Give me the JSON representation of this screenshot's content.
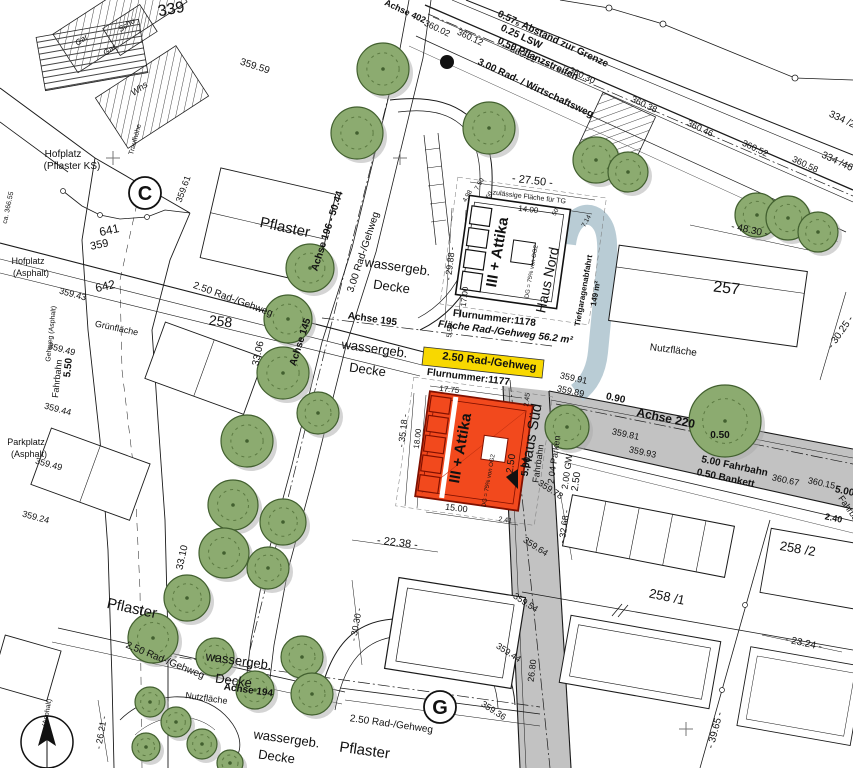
{
  "map": {
    "colors": {
      "tree_green": "#8cab70",
      "tree_outline": "#42602f",
      "tree_inner": "#5c7a42",
      "shadow_gray": "#a9a9a9",
      "road_gray": "#c2c2c2",
      "ramp_blue": "#b5c9d3",
      "path_yellow": "#f8d800",
      "building_red": "#f2491d",
      "building_red_border": "#801000",
      "line_black": "#1a1a1a"
    },
    "markers": [
      {
        "letter": "C"
      },
      {
        "letter": "G"
      }
    ],
    "labels": [
      {
        "t": "Achse 402",
        "x": 404,
        "y": 14,
        "r": 25,
        "s": 9,
        "b": 1
      },
      {
        "t": "360.02",
        "x": 436,
        "y": 31,
        "r": 25,
        "s": 9
      },
      {
        "t": "360.12",
        "x": 469,
        "y": 40,
        "r": 25,
        "s": 9
      },
      {
        "t": "360.22",
        "x": 522,
        "y": 57,
        "r": 25,
        "s": 9
      },
      {
        "t": "360.30",
        "x": 581,
        "y": 78,
        "r": 25,
        "s": 9
      },
      {
        "t": "360.38",
        "x": 643,
        "y": 107,
        "r": 25,
        "s": 9
      },
      {
        "t": "360.46",
        "x": 699,
        "y": 131,
        "r": 25,
        "s": 9
      },
      {
        "t": "360.52",
        "x": 754,
        "y": 151,
        "r": 25,
        "s": 9
      },
      {
        "t": "360.58",
        "x": 804,
        "y": 167,
        "r": 25,
        "s": 9
      },
      {
        "t": "0.57₅ Abstand zur Grenze",
        "x": 497,
        "y": 16,
        "r": 25,
        "s": 10,
        "b": 1,
        "a": "s"
      },
      {
        "t": "0.25 LSW",
        "x": 500,
        "y": 30,
        "r": 25,
        "s": 10,
        "b": 1,
        "a": "s"
      },
      {
        "t": "0.50 Pflanzstreifen",
        "x": 497,
        "y": 43,
        "r": 25,
        "s": 10,
        "b": 1,
        "a": "s"
      },
      {
        "t": "3.00 Rad- / Wirtschaftsweg",
        "x": 477,
        "y": 64,
        "r": 25,
        "s": 10,
        "b": 1,
        "a": "s"
      },
      {
        "t": "334 /2",
        "x": 841,
        "y": 122,
        "r": 25,
        "s": 10
      },
      {
        "t": "334 /46",
        "x": 836,
        "y": 164,
        "r": 25,
        "s": 10
      },
      {
        "t": "339",
        "x": 172,
        "y": 14,
        "r": -10,
        "s": 16
      },
      {
        "t": "359.59",
        "x": 254,
        "y": 69,
        "r": 18,
        "s": 10
      },
      {
        "t": "Schu",
        "x": 128,
        "y": 27,
        "r": -35,
        "s": 8,
        "i": 1
      },
      {
        "t": "Gar",
        "x": 83,
        "y": 42,
        "r": -35,
        "s": 8,
        "i": 1
      },
      {
        "t": "Gar",
        "x": 111,
        "y": 52,
        "r": -35,
        "s": 8,
        "i": 1
      },
      {
        "t": "Whs",
        "x": 141,
        "y": 91,
        "r": -35,
        "s": 9,
        "i": 1
      },
      {
        "t": "Traufhöhe",
        "x": 137,
        "y": 140,
        "r": -75,
        "s": 7
      },
      {
        "t": "ca. 366.55",
        "x": 10,
        "y": 208,
        "r": -78,
        "s": 7
      },
      {
        "t": "Hofplatz",
        "x": 63,
        "y": 157,
        "s": 10
      },
      {
        "t": "(Pflaster KS)",
        "x": 72,
        "y": 169,
        "s": 10
      },
      {
        "t": "359.61",
        "x": 186,
        "y": 190,
        "r": -70,
        "s": 9
      },
      {
        "t": "641",
        "x": 110,
        "y": 234,
        "r": -12,
        "s": 12
      },
      {
        "t": "359",
        "x": 100,
        "y": 248,
        "r": -12,
        "s": 11
      },
      {
        "t": "642",
        "x": 106,
        "y": 290,
        "r": -12,
        "s": 12
      },
      {
        "t": "359.43",
        "x": 72,
        "y": 297,
        "r": 15,
        "s": 9
      },
      {
        "t": "Hofplatz",
        "x": 28,
        "y": 264,
        "s": 9
      },
      {
        "t": "(Asphalt)",
        "x": 31,
        "y": 276,
        "s": 9
      },
      {
        "t": "Pflaster",
        "x": 284,
        "y": 232,
        "r": 12,
        "s": 15
      },
      {
        "t": "Achse 196 - 50.44",
        "x": 330,
        "y": 232,
        "r": -72,
        "s": 10,
        "b": 1
      },
      {
        "t": "3.00 Rad-/Gehweg",
        "x": 366,
        "y": 253,
        "r": -72,
        "s": 10
      },
      {
        "t": "wassergeb.",
        "x": 397,
        "y": 271,
        "r": 8,
        "s": 13
      },
      {
        "t": "Decke",
        "x": 391,
        "y": 291,
        "r": 8,
        "s": 13
      },
      {
        "t": "2.50 Rad-/Gehweg",
        "x": 232,
        "y": 302,
        "r": 20,
        "s": 10
      },
      {
        "t": "Achse 195",
        "x": 372,
        "y": 322,
        "r": 8,
        "s": 10,
        "b": 1
      },
      {
        "t": "wassergeb.",
        "x": 374,
        "y": 353,
        "r": 8,
        "s": 13
      },
      {
        "t": "Decke",
        "x": 367,
        "y": 374,
        "r": 8,
        "s": 13
      },
      {
        "t": "Achse 145",
        "x": 303,
        "y": 343,
        "r": -72,
        "s": 10,
        "b": 1
      },
      {
        "t": "33.06",
        "x": 261,
        "y": 354,
        "r": -78,
        "s": 10
      },
      {
        "t": "258",
        "x": 220,
        "y": 326,
        "r": 7,
        "s": 14
      },
      {
        "t": "33.10",
        "x": 185,
        "y": 558,
        "r": -78,
        "s": 10
      },
      {
        "t": "- 30.30 -",
        "x": 359,
        "y": 625,
        "r": -80,
        "s": 9
      },
      {
        "t": "- 22.38 -",
        "x": 397,
        "y": 546,
        "r": 7,
        "s": 11
      },
      {
        "t": "- 26.21 -",
        "x": 104,
        "y": 733,
        "r": -80,
        "s": 9
      },
      {
        "t": "Pflaster",
        "x": 131,
        "y": 613,
        "r": 12,
        "s": 15
      },
      {
        "t": "2.50 Rad-/Gehweg",
        "x": 164,
        "y": 663,
        "r": 22,
        "s": 10
      },
      {
        "t": "wassergeb.",
        "x": 238,
        "y": 665,
        "r": 8,
        "s": 13
      },
      {
        "t": "Decke",
        "x": 233,
        "y": 685,
        "r": 8,
        "s": 13
      },
      {
        "t": "Achse 194",
        "x": 248,
        "y": 693,
        "r": 8,
        "s": 10,
        "b": 1
      },
      {
        "t": "Nutzfläche",
        "x": 206,
        "y": 701,
        "r": 8,
        "s": 9,
        "c": "#9c9c9c"
      },
      {
        "t": "2.50 Rad-/Gehweg",
        "x": 391,
        "y": 727,
        "r": 8,
        "s": 10
      },
      {
        "t": "wassergeb.",
        "x": 286,
        "y": 743,
        "r": 8,
        "s": 13
      },
      {
        "t": "Decke",
        "x": 276,
        "y": 761,
        "r": 8,
        "s": 13
      },
      {
        "t": "Pflaster",
        "x": 364,
        "y": 755,
        "r": 8,
        "s": 15
      },
      {
        "t": "359.44",
        "x": 507,
        "y": 655,
        "r": 33,
        "s": 9
      },
      {
        "t": "359.36",
        "x": 492,
        "y": 713,
        "r": 33,
        "s": 9
      },
      {
        "t": "26.80",
        "x": 535,
        "y": 671,
        "r": -83,
        "s": 9
      },
      {
        "t": "- 27.50 -",
        "x": 532,
        "y": 184,
        "r": 7,
        "s": 11
      },
      {
        "t": "zulässige Fläche für TG",
        "x": 529,
        "y": 199,
        "r": 7,
        "s": 7,
        "c": "#8a8a8a"
      },
      {
        "t": "14.00",
        "x": 528,
        "y": 212,
        "r": 7,
        "s": 8
      },
      {
        "t": "4.98",
        "x": 469,
        "y": 197,
        "r": -60,
        "s": 6.5
      },
      {
        "t": "7.50",
        "x": 481,
        "y": 185,
        "r": -60,
        "s": 6.5
      },
      {
        "t": "50",
        "x": 491,
        "y": 196,
        "r": -60,
        "s": 6.5
      },
      {
        "t": "50",
        "x": 557,
        "y": 213,
        "r": -60,
        "s": 6.5
      },
      {
        "t": "7.14",
        "x": 588,
        "y": 222,
        "r": -60,
        "s": 6.5
      },
      {
        "t": "- 29.88 -",
        "x": 453,
        "y": 264,
        "r": -83,
        "s": 9
      },
      {
        "t": "17.00",
        "x": 467,
        "y": 297,
        "r": -83,
        "s": 8
      },
      {
        "t": "5.50",
        "x": 452,
        "y": 331,
        "r": -83,
        "s": 7
      },
      {
        "t": "III + Attika",
        "x": 502,
        "y": 253,
        "r": -80,
        "s": 15,
        "b": 1
      },
      {
        "t": "DG = 75% von OG2",
        "x": 533,
        "y": 272,
        "r": -80,
        "s": 6
      },
      {
        "t": "Haus Nord",
        "x": 552,
        "y": 281,
        "r": -78,
        "s": 14
      },
      {
        "t": "Tiefgaragenabfahrt",
        "x": 586,
        "y": 291,
        "r": -80,
        "s": 8,
        "b": 1
      },
      {
        "t": "149 m²",
        "x": 598,
        "y": 294,
        "r": -80,
        "s": 8,
        "b": 1
      },
      {
        "t": "Flurnummer:1178",
        "x": 494,
        "y": 321,
        "r": 7,
        "s": 10,
        "b": 1
      },
      {
        "t": "Fläche Rad-/Gehweg 56.2 m²",
        "x": 505,
        "y": 335,
        "r": 7,
        "s": 10,
        "b": 1,
        "i": 1
      },
      {
        "t": "2.50 Rad-/Gehweg",
        "x": 489,
        "y": 365,
        "r": 7,
        "s": 11,
        "b": 1
      },
      {
        "t": "Flurnummer:1177",
        "x": 468,
        "y": 380,
        "r": 7,
        "s": 10,
        "b": 1
      },
      {
        "t": "17.75",
        "x": 449,
        "y": 392,
        "r": 7,
        "s": 8
      },
      {
        "t": "- 35.18 -",
        "x": 406,
        "y": 431,
        "r": -83,
        "s": 9
      },
      {
        "t": "18.00",
        "x": 420,
        "y": 439,
        "r": -83,
        "s": 8
      },
      {
        "t": "III + Attika",
        "x": 465,
        "y": 449,
        "r": -80,
        "s": 15,
        "b": 1
      },
      {
        "t": "DG = 75% von OG2",
        "x": 490,
        "y": 481,
        "r": -80,
        "s": 6
      },
      {
        "t": "15.00",
        "x": 456,
        "y": 511,
        "r": 7,
        "s": 9
      },
      {
        "t": "2.45",
        "x": 529,
        "y": 400,
        "r": -83,
        "s": 7
      },
      {
        "t": "2.41",
        "x": 505,
        "y": 522,
        "r": 7,
        "s": 7
      },
      {
        "t": "Haus Süd",
        "x": 536,
        "y": 437,
        "r": -80,
        "s": 15
      },
      {
        "t": "2.50",
        "x": 514,
        "y": 464,
        "r": -82,
        "s": 10
      },
      {
        "t": "5.00",
        "x": 529,
        "y": 467,
        "r": -82,
        "s": 10,
        "b": 1
      },
      {
        "t": "Fahrbahn",
        "x": 541,
        "y": 464,
        "r": -82,
        "s": 9
      },
      {
        "t": "2.04 Parken",
        "x": 557,
        "y": 460,
        "r": -82,
        "s": 9
      },
      {
        "t": "2.00 GW",
        "x": 570,
        "y": 472,
        "r": -82,
        "s": 9
      },
      {
        "t": "2.50",
        "x": 579,
        "y": 482,
        "r": -82,
        "s": 10
      },
      {
        "t": "- 32.68 -",
        "x": 567,
        "y": 527,
        "r": -82,
        "s": 9
      },
      {
        "t": "359.78",
        "x": 549,
        "y": 492,
        "r": 33,
        "s": 9
      },
      {
        "t": "359.64",
        "x": 534,
        "y": 549,
        "r": 33,
        "s": 9
      },
      {
        "t": "359.54",
        "x": 524,
        "y": 605,
        "r": 33,
        "s": 9
      },
      {
        "t": "359.91",
        "x": 573,
        "y": 381,
        "r": 12,
        "s": 9
      },
      {
        "t": "359.89",
        "x": 570,
        "y": 394,
        "r": 12,
        "s": 9
      },
      {
        "t": "0.90",
        "x": 615,
        "y": 401,
        "r": 12,
        "s": 10,
        "b": 1
      },
      {
        "t": "Achse 220",
        "x": 665,
        "y": 422,
        "r": 12,
        "s": 12,
        "b": 1
      },
      {
        "t": "359.81",
        "x": 625,
        "y": 437,
        "r": 12,
        "s": 9
      },
      {
        "t": "359.93",
        "x": 642,
        "y": 455,
        "r": 12,
        "s": 9
      },
      {
        "t": "0.50",
        "x": 720,
        "y": 438,
        "s": 10,
        "b": 1
      },
      {
        "t": "5.00 Fahrbahn",
        "x": 734,
        "y": 469,
        "r": 12,
        "s": 10,
        "b": 1
      },
      {
        "t": "0.50 Bankett",
        "x": 725,
        "y": 481,
        "r": 12,
        "s": 10,
        "b": 1
      },
      {
        "t": "360.67",
        "x": 785,
        "y": 483,
        "r": 12,
        "s": 9
      },
      {
        "t": "360.15",
        "x": 821,
        "y": 486,
        "r": 12,
        "s": 9
      },
      {
        "t": "5.00",
        "x": 844,
        "y": 494,
        "r": 12,
        "s": 10,
        "b": 1
      },
      {
        "t": "Fahrbahn",
        "x": 849,
        "y": 514,
        "r": 55,
        "s": 9
      },
      {
        "t": "2.40",
        "x": 833,
        "y": 521,
        "r": 12,
        "s": 9,
        "b": 1
      },
      {
        "t": "- 30.25 -",
        "x": 843,
        "y": 334,
        "r": -55,
        "s": 10
      },
      {
        "t": "257",
        "x": 726,
        "y": 293,
        "r": 7,
        "s": 16
      },
      {
        "t": "Nutzfläche",
        "x": 673,
        "y": 353,
        "r": 7,
        "s": 10,
        "c": "#9c9c9c"
      },
      {
        "t": "- 48.30 -",
        "x": 749,
        "y": 233,
        "r": 12,
        "s": 10
      },
      {
        "t": "258 /2",
        "x": 797,
        "y": 553,
        "r": 10,
        "s": 13
      },
      {
        "t": "- 23.24 -",
        "x": 803,
        "y": 646,
        "r": 12,
        "s": 10
      },
      {
        "t": "258 /1",
        "x": 666,
        "y": 601,
        "r": 12,
        "s": 13
      },
      {
        "t": "- 39.65 -",
        "x": 718,
        "y": 731,
        "r": -75,
        "s": 10
      },
      {
        "t": "Grünfläche",
        "x": 116,
        "y": 331,
        "r": 12,
        "s": 9,
        "c": "#9c9c9c"
      },
      {
        "t": "Gehweg (Asphalt)",
        "x": 53,
        "y": 334,
        "r": -84,
        "s": 7
      },
      {
        "t": "5.50",
        "x": 71,
        "y": 368,
        "r": -84,
        "s": 10,
        "b": 1
      },
      {
        "t": "Fahrbahn",
        "x": 60,
        "y": 379,
        "r": -84,
        "s": 9
      },
      {
        "t": "359.49",
        "x": 61,
        "y": 352,
        "r": 15,
        "s": 9
      },
      {
        "t": "359.44",
        "x": 57,
        "y": 412,
        "r": 15,
        "s": 9
      },
      {
        "t": "359.49",
        "x": 48,
        "y": 467,
        "r": 15,
        "s": 9
      },
      {
        "t": "359.24",
        "x": 35,
        "y": 520,
        "r": 15,
        "s": 9
      },
      {
        "t": "Parkplatz",
        "x": 26,
        "y": 445,
        "s": 9
      },
      {
        "t": "(Asphalt)",
        "x": 29,
        "y": 457,
        "s": 9
      },
      {
        "t": "(Asphalt)",
        "x": 49,
        "y": 713,
        "r": -80,
        "s": 7
      }
    ],
    "trees": [
      [
        383,
        69,
        26
      ],
      [
        357,
        133,
        26
      ],
      [
        489,
        128,
        26
      ],
      [
        596,
        160,
        23
      ],
      [
        628,
        172,
        20
      ],
      [
        757,
        215,
        22
      ],
      [
        788,
        218,
        22
      ],
      [
        818,
        232,
        20
      ],
      [
        310,
        268,
        24
      ],
      [
        288,
        319,
        24
      ],
      [
        283,
        373,
        26
      ],
      [
        318,
        413,
        21
      ],
      [
        247,
        441,
        26
      ],
      [
        233,
        505,
        25
      ],
      [
        283,
        522,
        23
      ],
      [
        224,
        553,
        25
      ],
      [
        268,
        568,
        21
      ],
      [
        187,
        598,
        23
      ],
      [
        153,
        638,
        25
      ],
      [
        215,
        657,
        19
      ],
      [
        302,
        657,
        21
      ],
      [
        255,
        690,
        19
      ],
      [
        312,
        694,
        21
      ],
      [
        150,
        702,
        15
      ],
      [
        176,
        722,
        15
      ],
      [
        146,
        747,
        14
      ],
      [
        202,
        744,
        15
      ],
      [
        230,
        763,
        13
      ],
      [
        725,
        421,
        36
      ],
      [
        567,
        427,
        22
      ]
    ]
  }
}
